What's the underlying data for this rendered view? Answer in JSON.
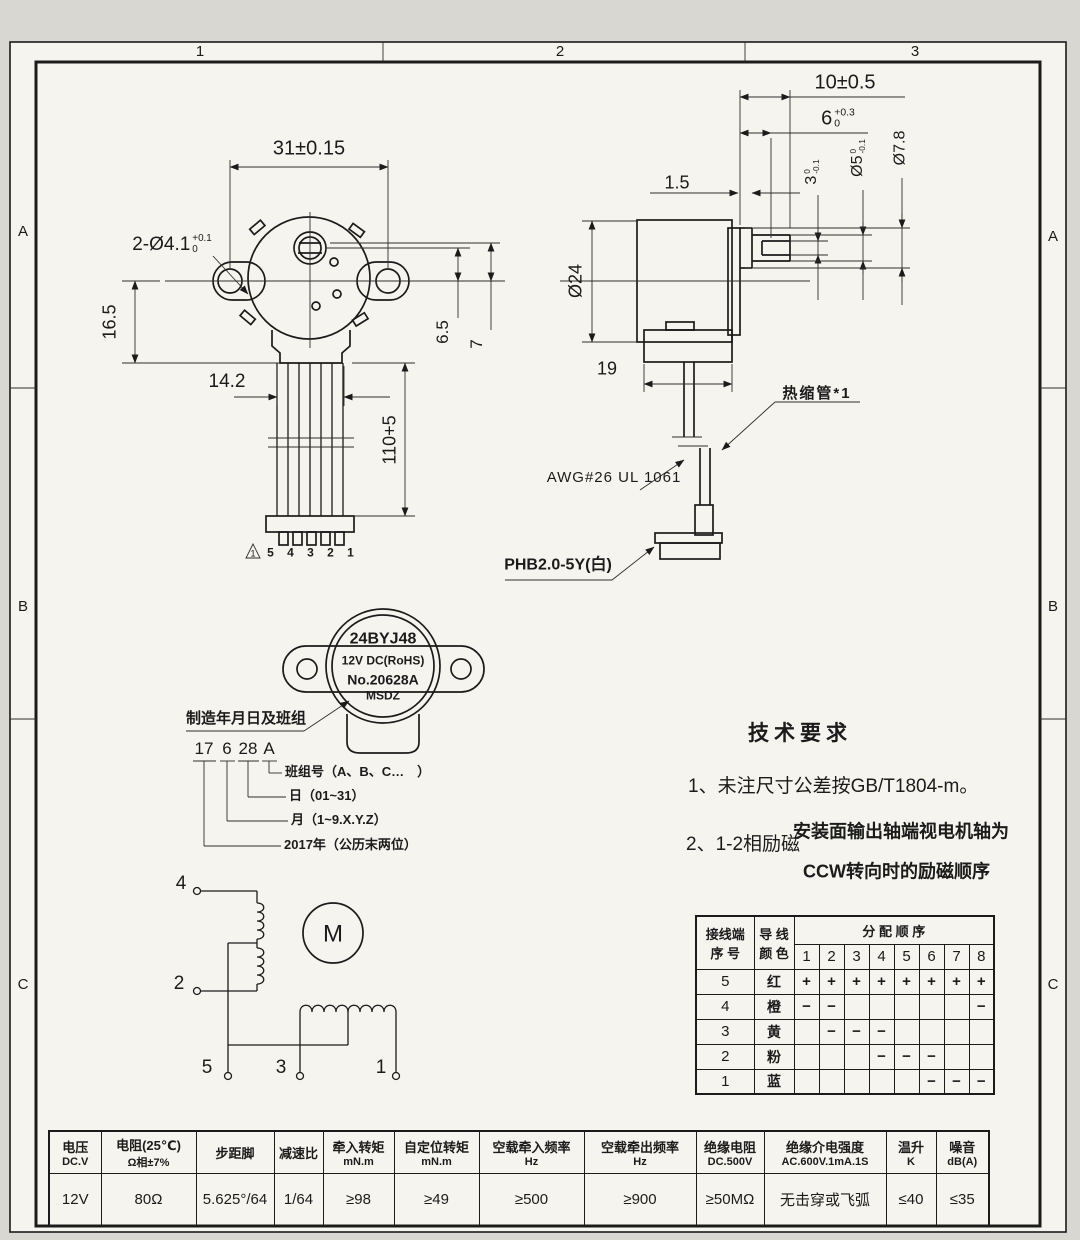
{
  "frame": {
    "top_zones": [
      "1",
      "2",
      "3"
    ],
    "left_zones": [
      "A",
      "B",
      "C"
    ],
    "right_zones": [
      "A",
      "B",
      "C"
    ]
  },
  "front_view": {
    "dim_width": "31±0.15",
    "dim_holes_main": "2-Ø4.1",
    "dim_holes_tol_up": "+0.1",
    "dim_holes_tol_dn": "0",
    "dim_offset": "16.5",
    "dim_bundle_width": "14.2",
    "dim_wire_length": "110+5",
    "dim_shaft_offset": "6.5",
    "dim_shaft_offset2": "7",
    "pin_numbers": "5 4 3 2 1",
    "note_marker": "1"
  },
  "side_view": {
    "dim_shaft_len": "10±0.5",
    "dim_flat_len_main": "6",
    "dim_flat_len_tol_up": "+0.3",
    "dim_flat_len_tol_dn": "0",
    "dim_step": "1.5",
    "dim_flat_main": "3",
    "dim_flat_tol_up": "0",
    "dim_flat_tol_dn": "-0.1",
    "dim_shaft_dia_main": "Ø5",
    "dim_shaft_dia_tol_up": "0",
    "dim_shaft_dia_tol_dn": "-0.1",
    "dim_boss_dia": "Ø7.8",
    "dim_body_dia": "Ø24",
    "dim_body_len": "19",
    "label_shrink_tube": "热缩管*1",
    "label_wire_spec": "AWG#26 UL 1061",
    "label_connector": "PHB2.0-5Y(白)"
  },
  "nameplate": {
    "model": "24BYJ48",
    "voltage": "12V DC(RoHS)",
    "serial": "No.20628A",
    "maker": "MSDZ"
  },
  "date_code": {
    "label": "制造年月日及班组",
    "year": "17",
    "month": "6",
    "day": "28",
    "shift": "A",
    "callout_shift": "班组号（A、B、C…　）",
    "callout_day": "日（01~31）",
    "callout_month": "月（1~9.X.Y.Z）",
    "callout_year": "2017年（公历末两位）"
  },
  "tech_req": {
    "title": "技术要求",
    "item1": "1、未注尺寸公差按GB/T1804-m。",
    "item2_label": "2、1-2相励磁",
    "item2_line1": "安装面输出轴端视电机轴为",
    "item2_line2": "CCW转向时的励磁顺序"
  },
  "wiring": {
    "motor_symbol": "M",
    "terminals": [
      "4",
      "2",
      "5",
      "3",
      "1"
    ]
  },
  "phase_table": {
    "header_col1_line1": "接线端",
    "header_col1_line2": "序 号",
    "header_col2_line1": "导 线",
    "header_col2_line2": "颜 色",
    "header_span": "分 配 顺 序",
    "steps": [
      "1",
      "2",
      "3",
      "4",
      "5",
      "6",
      "7",
      "8"
    ],
    "rows": [
      {
        "terminal": "5",
        "color": "红",
        "cells": [
          "+",
          "+",
          "+",
          "+",
          "+",
          "+",
          "+",
          "+"
        ]
      },
      {
        "terminal": "4",
        "color": "橙",
        "cells": [
          "−",
          "−",
          "",
          "",
          "",
          "",
          "",
          "−"
        ]
      },
      {
        "terminal": "3",
        "color": "黄",
        "cells": [
          "",
          "−",
          "−",
          "−",
          "",
          "",
          "",
          ""
        ]
      },
      {
        "terminal": "2",
        "color": "粉",
        "cells": [
          "",
          "",
          "",
          "−",
          "−",
          "−",
          "",
          ""
        ]
      },
      {
        "terminal": "1",
        "color": "蓝",
        "cells": [
          "",
          "",
          "",
          "",
          "",
          "−",
          "−",
          "−"
        ]
      }
    ]
  },
  "spec_table": {
    "columns": [
      {
        "h1": "电压",
        "h2": "DC.V",
        "value": "12V"
      },
      {
        "h1": "电阻(25℃)",
        "h2": "Ω相±7%",
        "value": "80Ω"
      },
      {
        "h1": "步距脚",
        "h2": "",
        "value": "5.625°/64"
      },
      {
        "h1": "减速比",
        "h2": "",
        "value": "1/64"
      },
      {
        "h1": "牵入转矩",
        "h2": "mN.m",
        "value": "≥98"
      },
      {
        "h1": "自定位转矩",
        "h2": "mN.m",
        "value": "≥49"
      },
      {
        "h1": "空载牵入频率",
        "h2": "Hz",
        "value": "≥500"
      },
      {
        "h1": "空载牵出频率",
        "h2": "Hz",
        "value": "≥900"
      },
      {
        "h1": "绝缘电阻",
        "h2": "DC.500V",
        "value": "≥50MΩ"
      },
      {
        "h1": "绝缘介电强度",
        "h2": "AC.600V.1mA.1S",
        "value": "无击穿或飞弧"
      },
      {
        "h1": "温升",
        "h2": "K",
        "value": "≤40"
      },
      {
        "h1": "噪音",
        "h2": "dB(A)",
        "value": "≤35"
      }
    ]
  }
}
